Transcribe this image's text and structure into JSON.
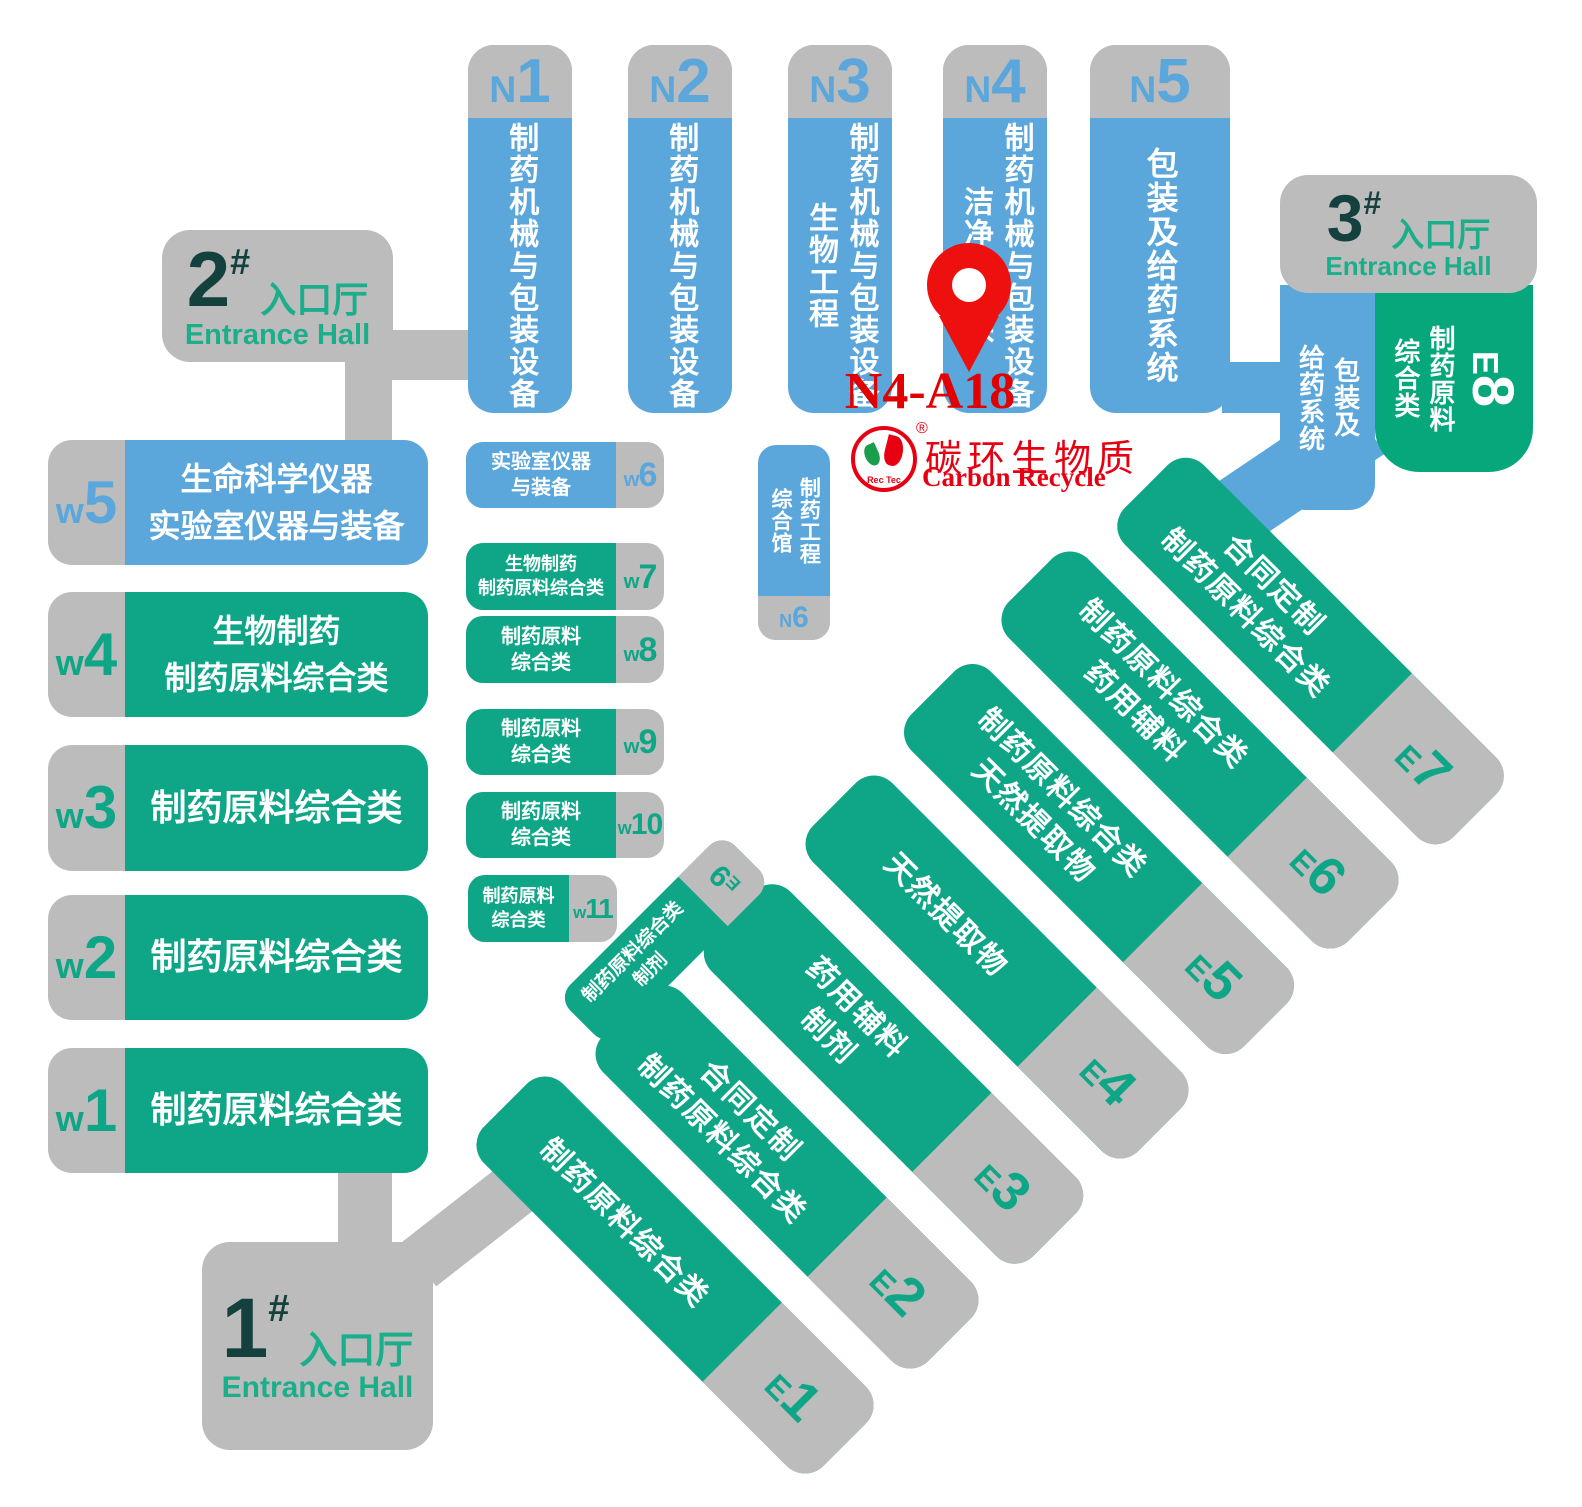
{
  "pin": {
    "booth": "N4-A18"
  },
  "logo": {
    "reg": "®",
    "cn": "碳环生物质",
    "en": "Carbon Recycle",
    "mark": "Rec Tec"
  },
  "north_halls": [
    {
      "label": "N1",
      "category": "制药机械与包装设备"
    },
    {
      "label": "N2",
      "category": "制药机械与包装设备"
    },
    {
      "label": "N3",
      "category": "制药机械与包装设备\n生物工程"
    },
    {
      "label": "N4",
      "category": "制药机械与包装设备\n洁净与环保"
    },
    {
      "label": "N5",
      "category": "包装及给药系统"
    },
    {
      "label": "N6",
      "category": "制药工程\n综合馆"
    }
  ],
  "west_halls": [
    {
      "label": "w5",
      "category": "生命科学仪器\n实验室仪器与装备"
    },
    {
      "label": "w4",
      "category": "生物制药\n制药原料综合类"
    },
    {
      "label": "w3",
      "category": "制药原料综合类"
    },
    {
      "label": "w2",
      "category": "制药原料综合类"
    },
    {
      "label": "w1",
      "category": "制药原料综合类"
    }
  ],
  "west_small": [
    {
      "label": "w6",
      "category": "实验室仪器\n与装备"
    },
    {
      "label": "w7",
      "category": "生物制药\n制药原料综合类"
    },
    {
      "label": "w8",
      "category": "制药原料\n综合类"
    },
    {
      "label": "w9",
      "category": "制药原料\n综合类"
    },
    {
      "label": "w10",
      "category": "制药原料\n综合类"
    },
    {
      "label": "w11",
      "category": "制药原料\n综合类"
    }
  ],
  "east_halls": [
    {
      "label": "E1",
      "category": "制药原料综合类"
    },
    {
      "label": "E2",
      "category": "合同定制\n制药原料综合类"
    },
    {
      "label": "E3",
      "category": "药用辅料\n制剂"
    },
    {
      "label": "E4",
      "category": "天然提取物"
    },
    {
      "label": "E5",
      "category": "制药原料综合类\n天然提取物"
    },
    {
      "label": "E6",
      "category": "制药原料综合类\n药用辅料"
    },
    {
      "label": "E7",
      "category": "合同定制\n制药原料综合类"
    }
  ],
  "e9": {
    "label": "E9",
    "category": "制药原料综合类\n制剂"
  },
  "e8": {
    "label": "E8",
    "category": "制药原料\n综合类",
    "packaging": "包装及\n给药系统"
  },
  "entrances": [
    {
      "num": "1",
      "hash": "#",
      "cn": "入口厅",
      "en": "Entrance Hall"
    },
    {
      "num": "2",
      "hash": "#",
      "cn": "入口厅",
      "en": "Entrance Hall"
    },
    {
      "num": "3",
      "hash": "#",
      "cn": "入口厅",
      "en": "Entrance Hall"
    }
  ],
  "colors": {
    "blue": "#5ba7dc",
    "green": "#0fa687",
    "e8_green": "#05a77b",
    "gray": "#bcbcbc",
    "dark_teal": "#14403d",
    "entrance_green": "#1bae8b",
    "red": "#e60012"
  }
}
